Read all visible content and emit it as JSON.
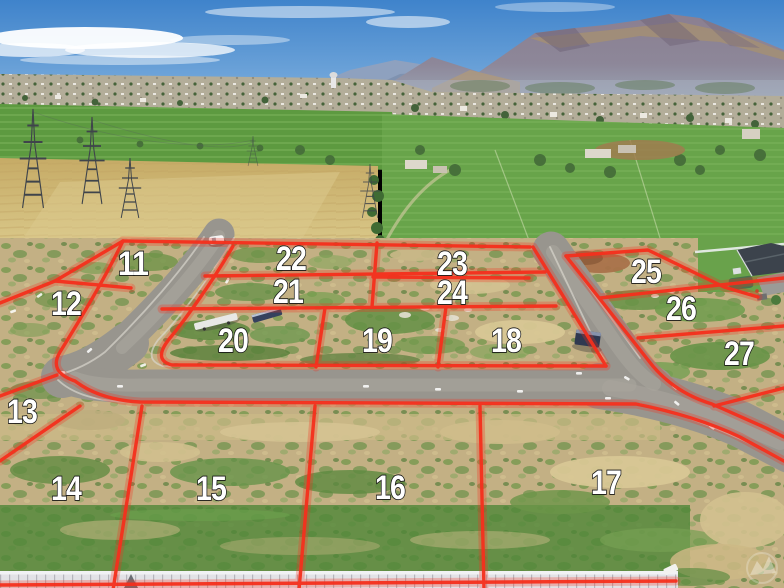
{
  "lots": [
    {
      "label": "11"
    },
    {
      "label": "12"
    },
    {
      "label": "13"
    },
    {
      "label": "14"
    },
    {
      "label": "15"
    },
    {
      "label": "16"
    },
    {
      "label": "17"
    },
    {
      "label": "18"
    },
    {
      "label": "19"
    },
    {
      "label": "20"
    },
    {
      "label": "21"
    },
    {
      "label": "22"
    },
    {
      "label": "23"
    },
    {
      "label": "24"
    },
    {
      "label": "25"
    },
    {
      "label": "26"
    },
    {
      "label": "27"
    }
  ],
  "colors": {
    "lot_line": "#f5301d",
    "lot_label_fill": "#ffffff",
    "lot_label_stroke": "#141414",
    "road": "#98958e",
    "sky_top": "#3f83cb",
    "grass": "#66a247",
    "wheat": "#cfb572",
    "scrub": "#c3b084",
    "fence": "#e2e2e6"
  },
  "watermark": {
    "icon": "mountain-logo"
  }
}
